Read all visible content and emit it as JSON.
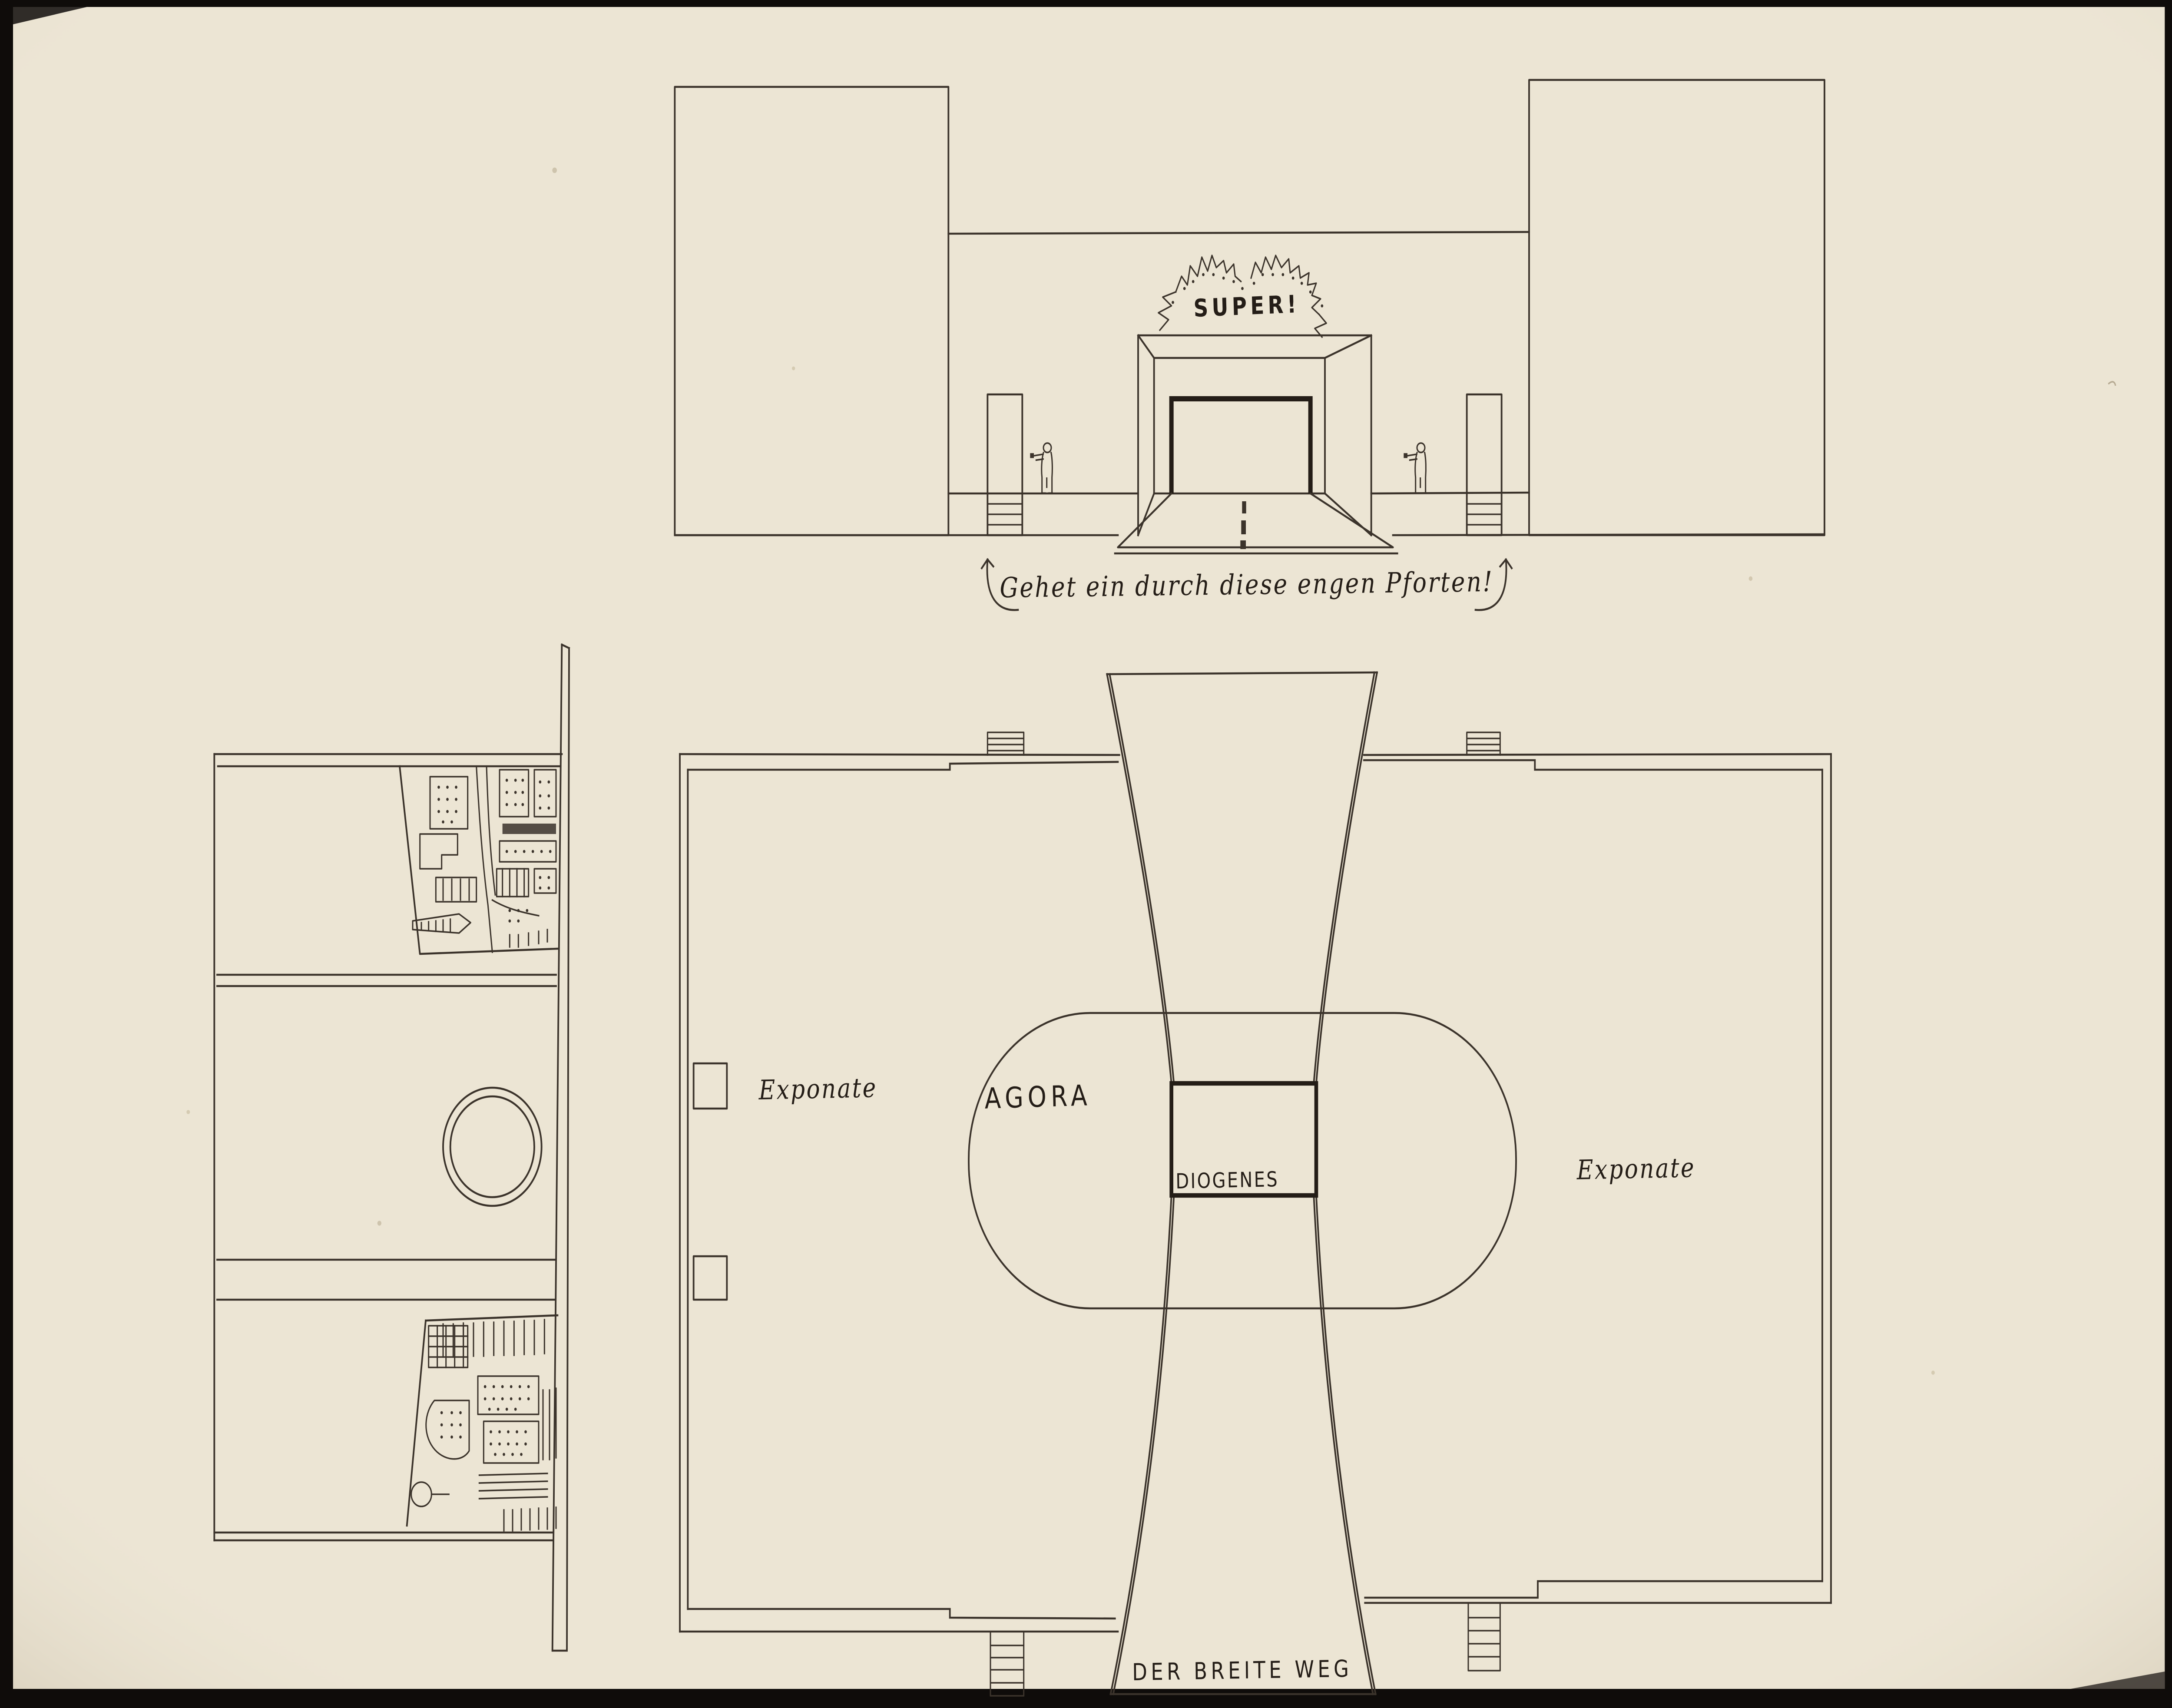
{
  "colors": {
    "paper": "#ece5d4",
    "paper_shadow": "#d8cfb6",
    "ink": "#3b332b",
    "ink_bold": "#241d17",
    "frame": "#0f0c0a"
  },
  "elevation": {
    "super_label": "SUPER!",
    "caption": "Gehet ein durch diese engen Pforten!"
  },
  "plan": {
    "exponate_left_label": "Exponate",
    "agora_label": "AGORA",
    "diogenes_label": "DIOGENES",
    "exponate_right_label": "Exponate",
    "breite_weg_label": "DER BREITE WEG"
  }
}
